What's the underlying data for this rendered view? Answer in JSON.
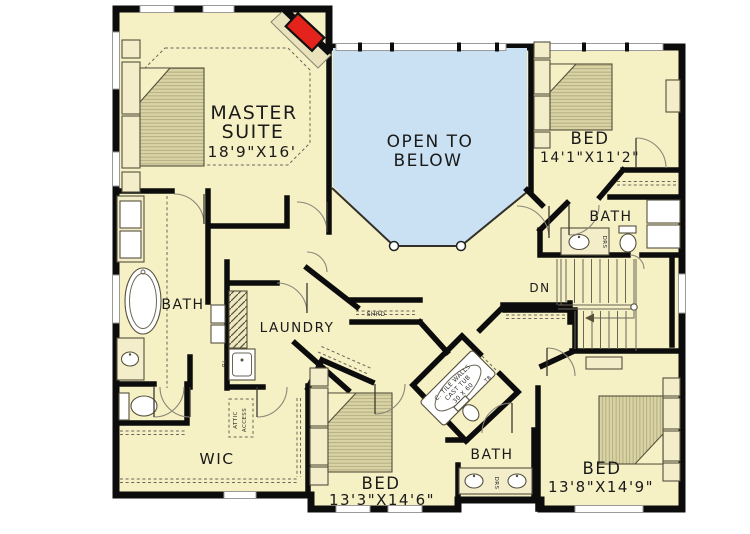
{
  "colors": {
    "floor": "#f6f0c5",
    "open_below": "#c9e1f2",
    "wall": "#0c0c0c",
    "fireplace_red": "#e3231c",
    "furniture_tan": "#dad4a5"
  },
  "rooms": {
    "master_suite": {
      "line1": "MASTER",
      "line2": "SUITE",
      "dims": "18'9\"X16'"
    },
    "open_to_below": {
      "line1": "OPEN TO",
      "line2": "BELOW"
    },
    "bedroom_upper_right": {
      "label": "BED",
      "dims": "14'1\"X11'2\""
    },
    "bath_upper_right": {
      "label": "BATH"
    },
    "master_bath": {
      "label": "BATH"
    },
    "laundry": {
      "label": "LAUNDRY"
    },
    "stairs": {
      "label": "DN"
    },
    "walk_in_closet": {
      "label": "WIC"
    },
    "bath_lower": {
      "label": "BATH"
    },
    "bedroom_lower_center": {
      "label": "BED",
      "dims": "13'3\"X14'6\""
    },
    "bedroom_lower_right": {
      "label": "BED",
      "dims": "13'8\"X14'9\""
    }
  },
  "annotations": {
    "attic_access": {
      "line1": "ATTIC",
      "line2": "ACCESS"
    },
    "shelf_rod": "SHRD",
    "drawers": "DRS",
    "towel_bar": "TB",
    "tub_spec": {
      "line1": "C. TILE WALLS",
      "line2": "CAST TUB",
      "line3": "30 X 60"
    }
  }
}
